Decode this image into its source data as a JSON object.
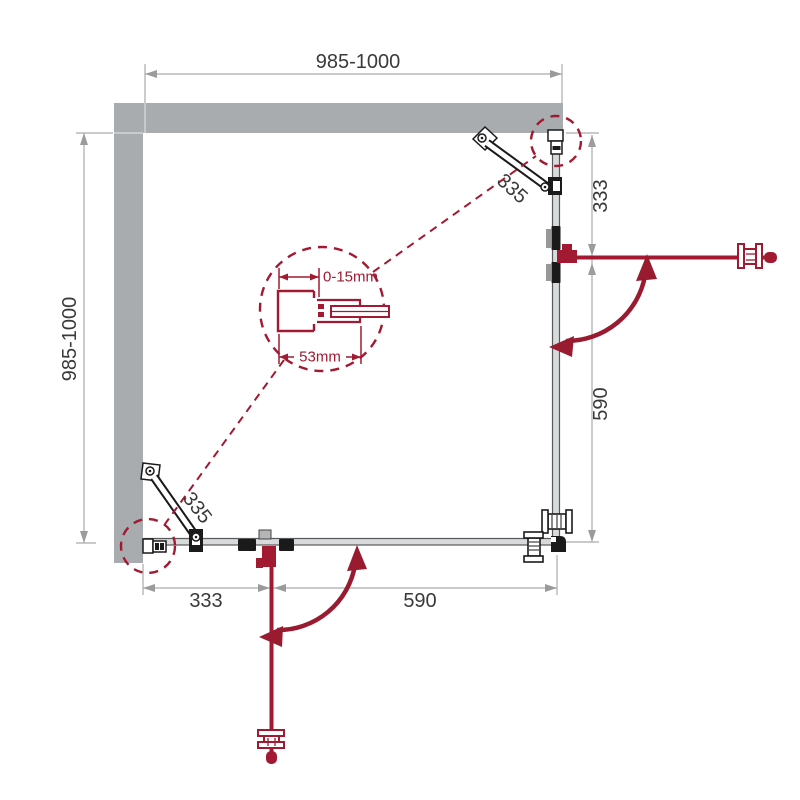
{
  "diagram": {
    "dims": {
      "top": "985-1000",
      "left": "985-1000",
      "right_upper": "333",
      "right_lower": "590",
      "bottom_left": "333",
      "bottom_right": "590"
    },
    "braces": {
      "top_right": "335",
      "bottom_left": "335"
    },
    "detail": {
      "adjustment": "0-15mm",
      "profile_width": "53mm"
    },
    "colors": {
      "accent_red": "#A11A31",
      "arc_red": "#991B30",
      "wall_gray": "#a8acae",
      "dim_gray": "#ababab",
      "arrow_gray": "#9b9b9b",
      "glass_fill": "#d8dadb",
      "glass_edge": "#58595b",
      "hardware_black": "#1a1a1a",
      "text": "#3a3a3a"
    }
  }
}
